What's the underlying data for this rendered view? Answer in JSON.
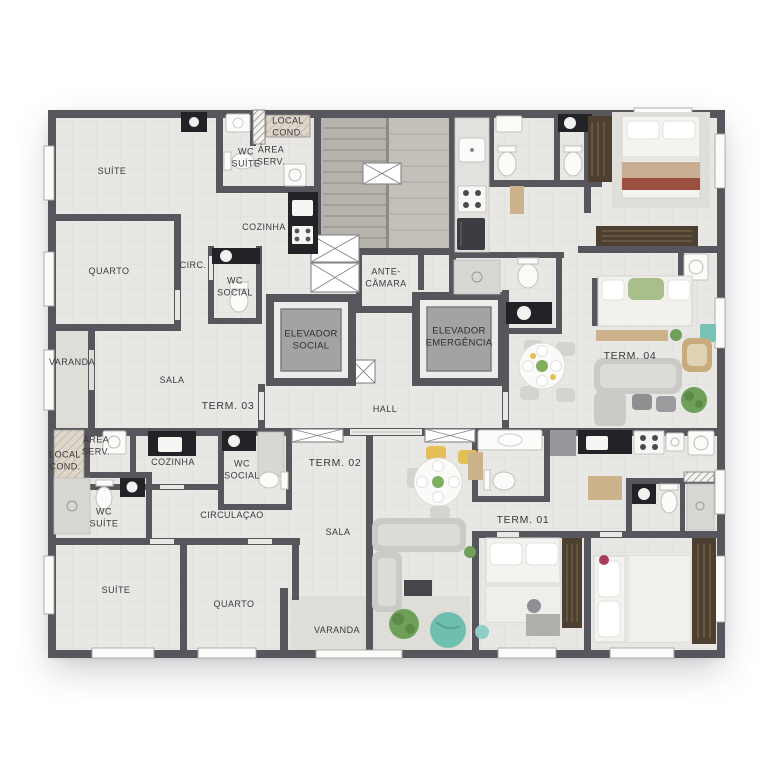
{
  "plan": {
    "core": {
      "ante_chamber": "ANTE-\nCÂMARA",
      "elevator_social": "ELEVADOR\nSOCIAL",
      "elevator_emergency": "ELEVADOR\nEMERGÊNCIA",
      "hall": "HALL"
    },
    "units": {
      "term03": {
        "name": "TERM. 03",
        "suite": "SUÍTE",
        "wc_suite": "WC\nSUÍTE",
        "local_cond": "LOCAL\nCOND.",
        "area_serv": "ÁREA\nSERV.",
        "cozinha": "COZINHA",
        "quarto": "QUARTO",
        "circ": "CIRC.",
        "wc_social": "WC\nSOCIAL",
        "varanda": "VARANDA",
        "sala": "SALA"
      },
      "term04": {
        "name": "TERM. 04"
      },
      "term02": {
        "name": "TERM. 02",
        "area_serv": "ÁREA\nSERV.",
        "local_cond": "LOCAL\nCOND.",
        "cozinha": "COZINHA",
        "wc_social": "WC\nSOCIAL",
        "wc_suite": "WC\nSUÍTE",
        "circulacao": "CIRCULAÇAO",
        "sala": "SALA",
        "suite": "SUÍTE",
        "quarto": "QUARTO",
        "varanda": "VARANDA"
      },
      "term01": {
        "name": "TERM. 01"
      }
    },
    "colors": {
      "wall": "#57565c",
      "floor": "#e9e7e4",
      "floor_dark": "#dfddd8",
      "stairs": "#b6b2ac",
      "counter": "#232327",
      "wood": "#ccb28a",
      "wardrobe": "#4e4030",
      "plant_green": "#6fa05a",
      "teal": "#6fbfae",
      "blanket_red": "#9c4f3e"
    }
  }
}
